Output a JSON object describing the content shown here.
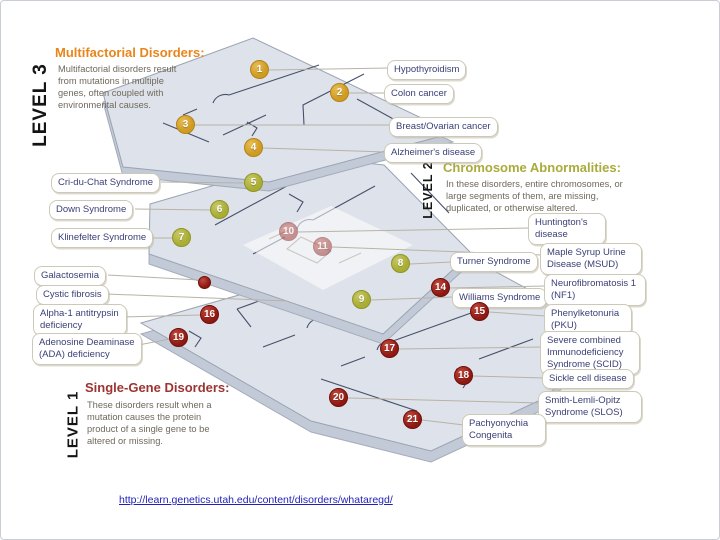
{
  "diagram": {
    "title_implicit": "Genetic disorders floor-plan diagram",
    "source_link": "http://learn.genetics.utah.edu/content/disorders/whataregd/"
  },
  "levels": [
    {
      "vertical_label": "LEVEL 3",
      "heading": "Multifactorial Disorders:",
      "description": "Multifactorial disorders result from mutations in multiple genes, often coupled with environmental causes."
    },
    {
      "vertical_label": "LEVEL 2",
      "heading": "Chromosome Abnormalities:",
      "description": "In these disorders, entire chromosomes, or large segments of them, are missing, duplicated, or otherwise altered."
    },
    {
      "vertical_label": "LEVEL 1",
      "heading": "Single-Gene Disorders:",
      "description": "These disorders result when a mutation causes the protein product of a single gene to be altered or missing."
    }
  ],
  "markers": [
    "1",
    "2",
    "3",
    "4",
    "5",
    "6",
    "7",
    "8",
    "9",
    "10",
    "11",
    "14",
    "15",
    "16",
    "17",
    "18",
    "19",
    "20",
    "21"
  ],
  "labels": [
    "Hypothyroidism",
    "Colon cancer",
    "Breast/Ovarian cancer",
    "Alzheimer's disease",
    "Cri-du-Chat Syndrome",
    "Down Syndrome",
    "Klinefelter Syndrome",
    "Turner Syndrome",
    "Williams Syndrome",
    "Huntington's disease",
    "Maple Syrup Urine Disease (MSUD)",
    "Neurofibromatosis 1 (NF1)",
    "Phenylketonuria (PKU)",
    "Severe combined Immunodeficiency Syndrome (SCID)",
    "Sickle cell disease",
    "Smith-Lemli-Opitz Syndrome (SLOS)",
    "Pachyonychia Congenita",
    "Galactosemia",
    "Cystic fibrosis",
    "Alpha-1 antitrypsin deficiency",
    "Adenosine Deaminase (ADA) deficiency"
  ],
  "colors": {
    "level3_accent": "#e8861c",
    "level2_accent": "#a9ab3b",
    "level1_accent": "#9c3432",
    "marker_gold": "#cf9b22",
    "marker_olive": "#a9ad33",
    "marker_red": "#8f1812",
    "label_text": "#3a3f75",
    "slab_fill": "#dee2ea",
    "link_blue": "#2222bb"
  }
}
